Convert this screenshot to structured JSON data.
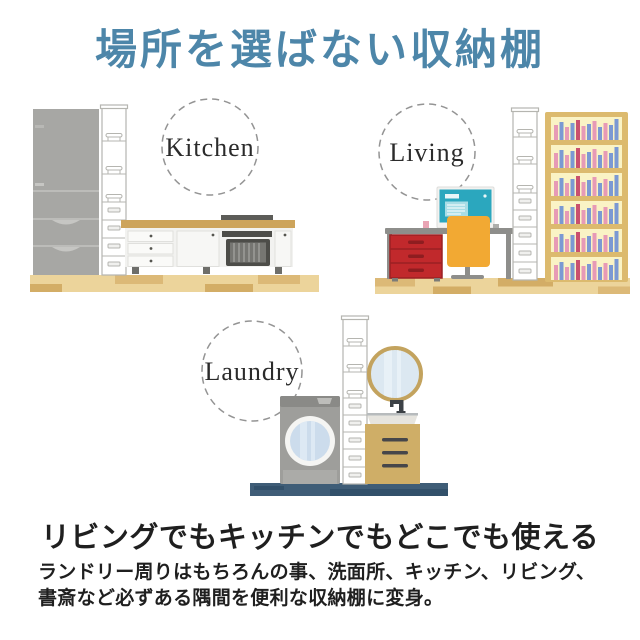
{
  "header": {
    "title": "場所を選ばない収納棚"
  },
  "scenes": {
    "kitchen": {
      "label": "Kitchen"
    },
    "living": {
      "label": "Living"
    },
    "laundry": {
      "label": "Laundry"
    }
  },
  "footer": {
    "heading": "リビングでもキッチンでもどこでも使える",
    "description_line1": "ランドリー周りはもちろんの事、洗面所、キッチン、リビング、",
    "description_line2": "書斎など必ずある隅間を便利な収納棚に変身。"
  },
  "colors": {
    "title_blue": "#4d86a9",
    "text_dark": "#1f1f1f",
    "label_circle_gray": "#949494",
    "appliance_gray": "#a7a7a4",
    "washer_gray": "#9e9e9b",
    "tower_white": "#ffffff",
    "tower_outline": "#b5b5b0",
    "wood_floor_tan": "#ecd49b",
    "wood_floor_dark": "#d3ad66",
    "counter_top_gold": "#cda45b",
    "oven_dark": "#4d4d49",
    "drawer_unit_red": "#c1292c",
    "drawer_unit_red_dark": "#9b2023",
    "chair_orange": "#f2a933",
    "monitor_teal": "#2ba7be",
    "desk_gray": "#8e8e8b",
    "bookshelf_tan": "#dcba6e",
    "bookshelf_back_yellow": "#faf3c5",
    "book_pink": "#e79ab6",
    "book_blue": "#7b99d3",
    "mirror_gold_frame": "#c3a35e",
    "mirror_glass_blue": "#dce8f1",
    "vanity_tan": "#cfae67",
    "laundry_floor_navy": "#3f5d77",
    "laundry_floor_navy_dark": "#32506a"
  }
}
